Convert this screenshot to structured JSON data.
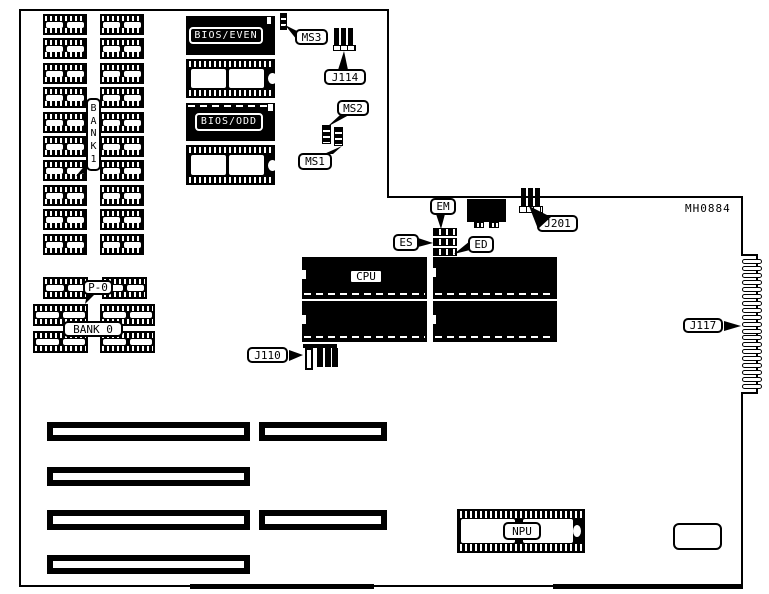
{
  "board": {
    "part_code": "MH0884",
    "colors": {
      "ink": "#000000",
      "paper": "#ffffff"
    },
    "chips": {
      "bios_even": "BIOS/EVEN",
      "bios_odd": "BIOS/ODD",
      "cpu": "CPU",
      "npu": "NPU"
    },
    "memory": {
      "bank1_label": "BANK1",
      "bank1_letters": [
        "B",
        "A",
        "N",
        "K",
        "1"
      ],
      "bank0_label": "BANK 0",
      "p0_label": "P-0"
    },
    "connectors": {
      "ms1": "MS1",
      "ms2": "MS2",
      "ms3": "MS3",
      "j110": "J110",
      "j114": "J114",
      "j117": "J117",
      "j201": "J201",
      "em": "EM",
      "es": "ES",
      "ed": "ED"
    },
    "structure": {
      "bank1_rows": 10,
      "bank1_columns": 2,
      "bank0_chip_count": 6,
      "edge_connector_fingers": 19,
      "expansion_slots_long": 4,
      "expansion_slots_short": 2
    }
  }
}
